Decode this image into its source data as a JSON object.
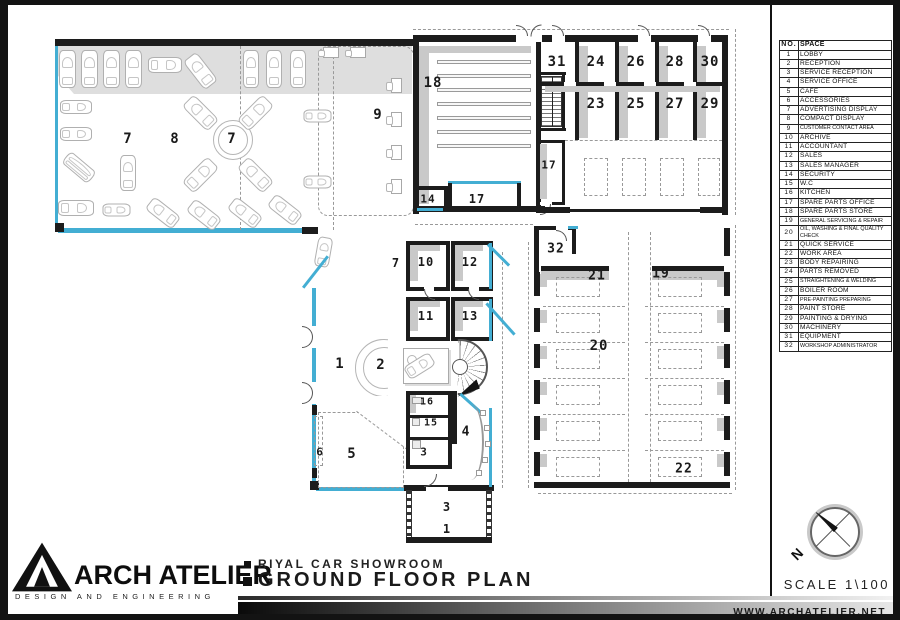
{
  "sheet": {
    "firm_name": "ARCH ATELIER",
    "firm_tagline": "DESIGN AND ENGINEERING",
    "project_title": "RIYAL CAR SHOWROOM",
    "drawing_title": "GROUND FLOOR PLAN",
    "scale_label": "SCALE 1\\100",
    "website": "WWW.ARCHATELIER.NET",
    "north_label": "N"
  },
  "legend": {
    "headers": {
      "no": "NO.",
      "space": "SPACE"
    },
    "rows": [
      {
        "no": "1",
        "space": "LOBBY"
      },
      {
        "no": "2",
        "space": "RECEPTION"
      },
      {
        "no": "3",
        "space": "SERVICE RECEPTION"
      },
      {
        "no": "4",
        "space": "SERVICE OFFICE"
      },
      {
        "no": "5",
        "space": "CAFE"
      },
      {
        "no": "6",
        "space": "ACCESSORIES"
      },
      {
        "no": "7",
        "space": "ADVERTISING DISPLAY"
      },
      {
        "no": "8",
        "space": "COMPACT DISPLAY"
      },
      {
        "no": "9",
        "space": "CUSTOMER CONTACT AREA"
      },
      {
        "no": "10",
        "space": "ARCHIVE"
      },
      {
        "no": "11",
        "space": "ACCOUNTANT"
      },
      {
        "no": "12",
        "space": "SALES"
      },
      {
        "no": "13",
        "space": "SALES MANAGER"
      },
      {
        "no": "14",
        "space": "SECURITY"
      },
      {
        "no": "15",
        "space": "W.C"
      },
      {
        "no": "16",
        "space": "KITCHEN"
      },
      {
        "no": "17",
        "space": "SPARE PARTS OFFICE"
      },
      {
        "no": "18",
        "space": "SPARE PARTS STORE"
      },
      {
        "no": "19",
        "space": "GENERAL SERVICING & REPAIR"
      },
      {
        "no": "20",
        "space": "OIL, WASHING & FINAL QUALITY CHECK"
      },
      {
        "no": "21",
        "space": "QUICK SERVICE"
      },
      {
        "no": "22",
        "space": "WORK AREA"
      },
      {
        "no": "23",
        "space": "BODY REPAIRING"
      },
      {
        "no": "24",
        "space": "PARTS REMOVED"
      },
      {
        "no": "25",
        "space": "STRAIGHTENING & WELDING"
      },
      {
        "no": "26",
        "space": "BOILER ROOM"
      },
      {
        "no": "27",
        "space": "PRE-PAINTING PREPARING"
      },
      {
        "no": "28",
        "space": "PAINT STORE"
      },
      {
        "no": "29",
        "space": "PAINTING & DRYING"
      },
      {
        "no": "30",
        "space": "MACHINERY"
      },
      {
        "no": "31",
        "space": "EQUIPMENT"
      },
      {
        "no": "32",
        "space": "WORKSHOP ADMINISTRATOR"
      }
    ]
  },
  "plan": {
    "room_labels": [
      {
        "t": "7",
        "x": 128,
        "y": 139
      },
      {
        "t": "8",
        "x": 175,
        "y": 139
      },
      {
        "t": "7",
        "x": 232,
        "y": 139
      },
      {
        "t": "9",
        "x": 378,
        "y": 115
      },
      {
        "t": "18",
        "x": 433,
        "y": 83
      },
      {
        "t": "31",
        "x": 557,
        "y": 62
      },
      {
        "t": "24",
        "x": 596,
        "y": 62
      },
      {
        "t": "26",
        "x": 636,
        "y": 62
      },
      {
        "t": "28",
        "x": 675,
        "y": 62
      },
      {
        "t": "30",
        "x": 710,
        "y": 62
      },
      {
        "t": "23",
        "x": 596,
        "y": 104
      },
      {
        "t": "25",
        "x": 636,
        "y": 104
      },
      {
        "t": "27",
        "x": 675,
        "y": 104
      },
      {
        "t": "29",
        "x": 710,
        "y": 104
      },
      {
        "t": "17",
        "x": 549,
        "y": 165,
        "s": 11
      },
      {
        "t": "14",
        "x": 428,
        "y": 199,
        "s": 11
      },
      {
        "t": "17",
        "x": 477,
        "y": 199,
        "s": 12
      },
      {
        "t": "32",
        "x": 556,
        "y": 249,
        "s": 13
      },
      {
        "t": "21",
        "x": 597,
        "y": 276,
        "s": 13
      },
      {
        "t": "19",
        "x": 661,
        "y": 274,
        "s": 13
      },
      {
        "t": "20",
        "x": 599,
        "y": 346
      },
      {
        "t": "22",
        "x": 684,
        "y": 469,
        "s": 13
      },
      {
        "t": "7",
        "x": 396,
        "y": 263,
        "s": 12
      },
      {
        "t": "10",
        "x": 426,
        "y": 262,
        "s": 12
      },
      {
        "t": "12",
        "x": 470,
        "y": 262,
        "s": 12
      },
      {
        "t": "11",
        "x": 426,
        "y": 316,
        "s": 12
      },
      {
        "t": "13",
        "x": 470,
        "y": 316,
        "s": 12
      },
      {
        "t": "1",
        "x": 340,
        "y": 364
      },
      {
        "t": "2",
        "x": 381,
        "y": 365
      },
      {
        "t": "16",
        "x": 427,
        "y": 402,
        "s": 10
      },
      {
        "t": "15",
        "x": 431,
        "y": 423,
        "s": 10
      },
      {
        "t": "3",
        "x": 424,
        "y": 452,
        "s": 11
      },
      {
        "t": "4",
        "x": 466,
        "y": 432,
        "s": 13
      },
      {
        "t": "5",
        "x": 352,
        "y": 454
      },
      {
        "t": "6",
        "x": 320,
        "y": 452,
        "s": 11
      },
      {
        "t": "3",
        "x": 447,
        "y": 507,
        "s": 12
      },
      {
        "t": "1",
        "x": 447,
        "y": 529,
        "s": 12
      }
    ]
  },
  "colors": {
    "glass": "#43AED3",
    "wall": "#1C1C1C",
    "shadow": "#C9C9C9"
  }
}
